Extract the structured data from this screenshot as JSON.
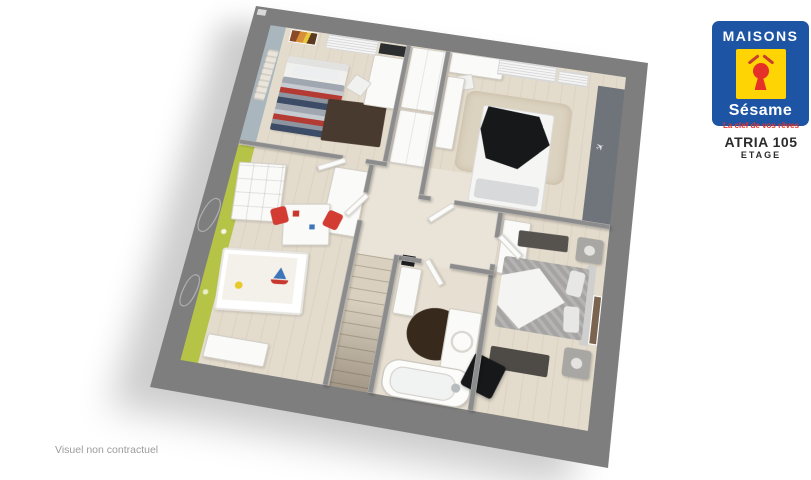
{
  "theme": {
    "page_bg": "#ffffff",
    "wall_outer": "#7e7e7e",
    "wall_inner": "#8c8c8c",
    "floor": "#e3dbcc",
    "floor_light": "#eae4d8",
    "floor_bath": "#e7e0d2",
    "stairs_wood": "#d9d0bf",
    "accent_blue": "#a9b6bd",
    "accent_green": "#b5c347",
    "runner_dark": "#6e747a",
    "rug_brown": "#483a2e",
    "rug_bath": "#38291d",
    "rug_beige": "#dbd2bf",
    "furn_white": "#fafaf8",
    "furn_border": "#d3cfc8",
    "black": "#17181a",
    "stripe_red": "#b43b33",
    "stripe_navy": "#3d4c66",
    "stripe_gray": "#a0a7b1",
    "bed_gray": "#a6a4a2",
    "sheet_white": "#f4f4f2",
    "chair_red": "#d23c32",
    "logo_blue": "#1d55a4",
    "logo_yellow": "#ffd404",
    "logo_red": "#e63128",
    "title_color": "#2b2b2b",
    "note_color": "#9c9c9c"
  },
  "branding": {
    "brand_top": "MAISONS",
    "brand_name": "Sésame",
    "tagline": "La clef de vos rêves"
  },
  "plan": {
    "model": "ATRIA 105",
    "level": "ETAGE"
  },
  "footer": {
    "note": "Visuel non contractuel"
  },
  "icons": {
    "airplane": "✈"
  },
  "floorplan": {
    "rooms": [
      {
        "name": "bedroom-top-left"
      },
      {
        "name": "bedroom-top-right"
      },
      {
        "name": "bedroom-kids"
      },
      {
        "name": "bedroom-master"
      },
      {
        "name": "bathroom"
      },
      {
        "name": "landing"
      },
      {
        "name": "staircase"
      }
    ]
  }
}
